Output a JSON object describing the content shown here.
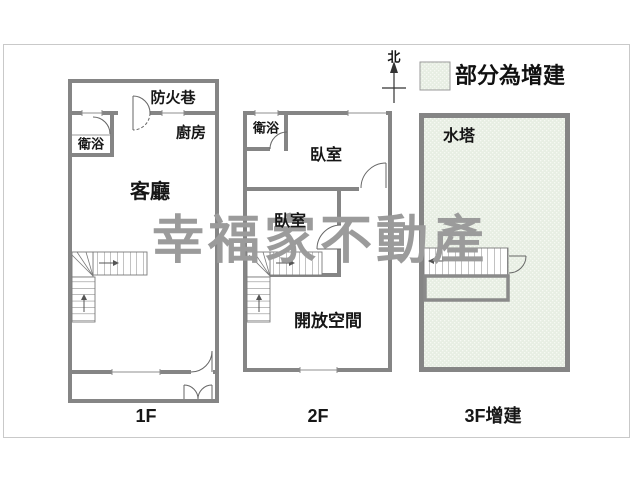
{
  "compass": {
    "north": "北"
  },
  "legend": {
    "text": "部分為增建",
    "swatch_color": "#e7eee3"
  },
  "watermark": {
    "text": "幸福家不動產",
    "color": "#9b9b9b"
  },
  "colors": {
    "wall": "#858585",
    "door_line": "#666666",
    "border": "#c9c9c9"
  },
  "floor_1f": {
    "label": "1F",
    "fire_lane": "防火巷",
    "bathroom": "衛浴",
    "kitchen": "廚房",
    "living_room": "客廳"
  },
  "floor_2f": {
    "label": "2F",
    "bathroom": "衛浴",
    "bedroom_top": "臥室",
    "bedroom_bottom": "臥室",
    "open_space": "開放空間"
  },
  "floor_3f": {
    "label": "3F增建",
    "water_tower": "水塔"
  }
}
